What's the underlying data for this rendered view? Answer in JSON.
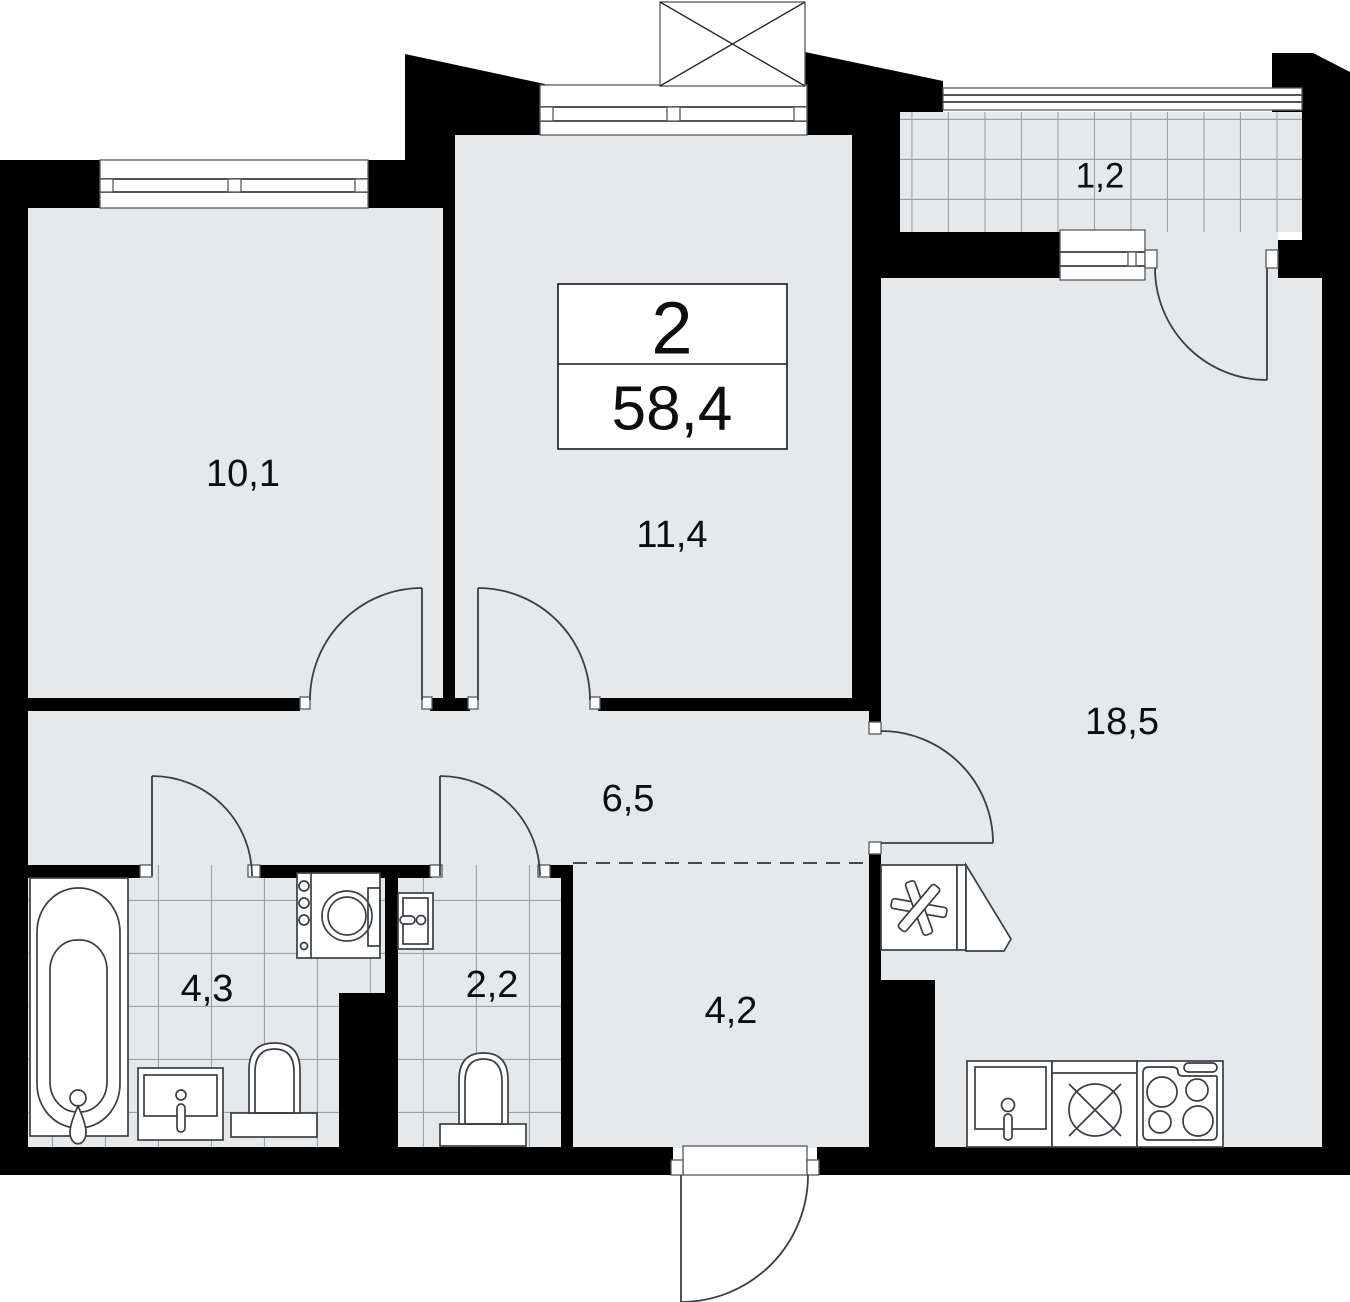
{
  "plan": {
    "title_block": {
      "rooms_count": "2",
      "total_area": "58,4"
    },
    "rooms": [
      {
        "id": "living-room-1",
        "area": "10,1"
      },
      {
        "id": "living-room-2",
        "area": "11,4"
      },
      {
        "id": "kitchen-living-room",
        "area": "18,5"
      },
      {
        "id": "hallway",
        "area": "6,5"
      },
      {
        "id": "bathroom",
        "area": "4,3"
      },
      {
        "id": "toilet",
        "area": "2,2"
      },
      {
        "id": "entry-hall",
        "area": "4,2"
      },
      {
        "id": "balcony",
        "area": "1,2"
      }
    ]
  },
  "colors": {
    "wall": "#000000",
    "floor": "#e6e9ec",
    "tile-line": "#99a1a9",
    "line": "#3a3f45",
    "frame": "#55595f",
    "label": "#0d0d0d",
    "exterior": "#ffffff"
  },
  "fixtures": [
    "bathtub",
    "washing-machine",
    "bathroom-sink",
    "toilet",
    "wall-sink",
    "kitchen-sink",
    "hob",
    "stove",
    "refrigerator",
    "air-conditioner-box",
    "window",
    "balcony-railing",
    "door-swing"
  ]
}
